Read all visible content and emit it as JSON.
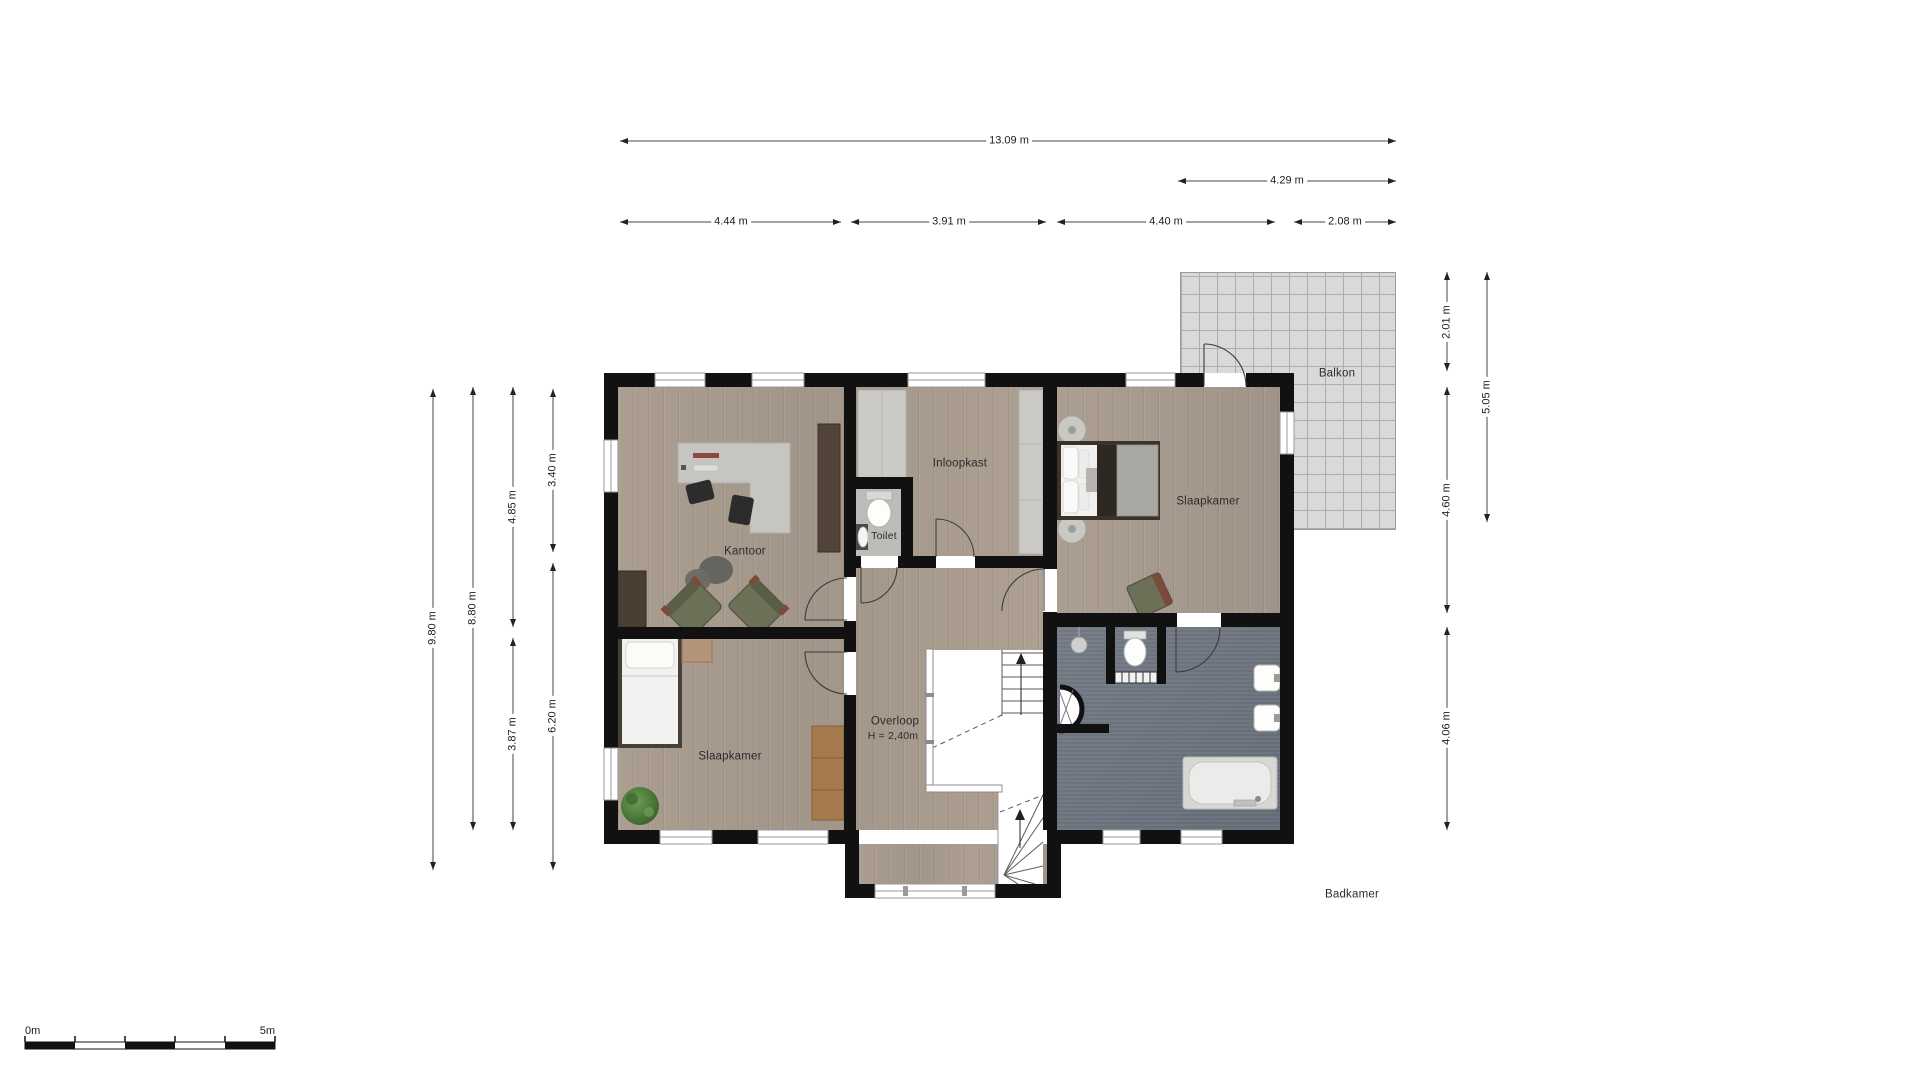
{
  "plan": {
    "rooms": {
      "kantoor": "Kantoor",
      "toilet": "Toilet",
      "inloopkast": "Inloopkast",
      "slaapkamer_master": "Slaapkamer",
      "slaapkamer_tweede": "Slaapkamer",
      "overloop": "Overloop",
      "overloop_hoogte": "H = 2,40m",
      "balkon": "Balkon",
      "badkamer": "Badkamer"
    },
    "dimensions": {
      "top_total": "13.09 m",
      "top_balkon": "4.29 m",
      "top_seg_1": "4.44 m",
      "top_seg_2": "3.91 m",
      "top_seg_3": "4.40 m",
      "top_seg_4": "2.08 m",
      "left_total": "9.80 m",
      "left_inner": "8.80 m",
      "left_kantoor": "4.85 m",
      "left_slaapkamer": "3.87 m",
      "left_boven": "3.40 m",
      "left_onder": "6.20 m",
      "right_balkon_boven": "2.01 m",
      "right_balkon_totaal": "5.05 m",
      "right_slaapkamer": "4.60 m",
      "right_badkamer": "4.06 m"
    },
    "scale_bar": {
      "start": "0m",
      "end": "5m"
    },
    "colors": {
      "wall": "#111111",
      "wood_floor": "#a89b8d",
      "bathroom_floor": "#6d7580",
      "balcony_tile": "#d9d9d8",
      "chair_accent": "#6b7057"
    }
  }
}
